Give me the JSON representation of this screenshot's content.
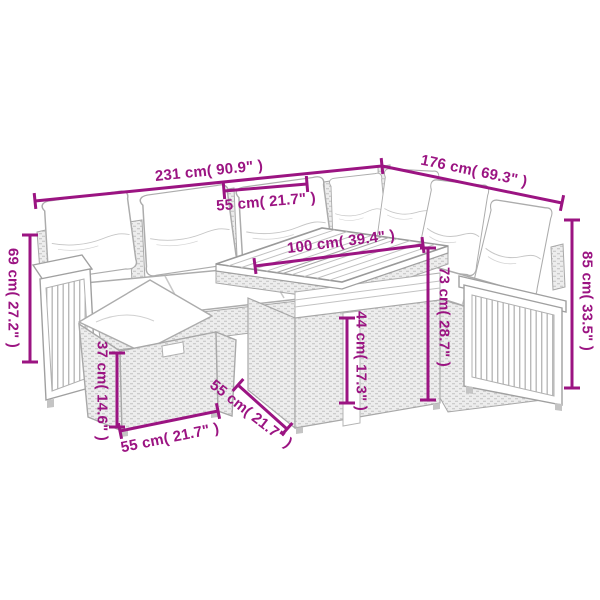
{
  "page": {
    "background": "#ffffff",
    "description": "Product dimension diagram of a modular rattan garden lounge set (corner sofa, ottoman and cube table) drawn as light grey line art with magenta measurement lines"
  },
  "diagram": {
    "accent_color": "#9B1482",
    "sketch_color": "#ACACAC",
    "labels": {
      "overall_width": {
        "text": "231 cm( 90.9\" )",
        "cm": 231,
        "in": 90.9
      },
      "overall_depth": {
        "text": "176 cm( 69.3\" )",
        "cm": 176,
        "in": 69.3
      },
      "seat_width": {
        "text": "55 cm( 21.7\" )",
        "cm": 55,
        "in": 21.7
      },
      "table_length": {
        "text": "100 cm( 39.4\" )",
        "cm": 100,
        "in": 39.4
      },
      "arm_height": {
        "text": "69 cm( 27.2\" )",
        "cm": 69,
        "in": 27.2
      },
      "ottoman_height": {
        "text": "37 cm( 14.6\" )",
        "cm": 37,
        "in": 14.6
      },
      "ottoman_width": {
        "text": "55 cm( 21.7\" )",
        "cm": 55,
        "in": 21.7
      },
      "table_depth": {
        "text": "55 cm( 21.7\" )",
        "cm": 55,
        "in": 21.7
      },
      "table_height": {
        "text": "44 cm( 17.3\" )",
        "cm": 44,
        "in": 17.3
      },
      "sofa_body_height": {
        "text": "73 cm( 28.7\" )",
        "cm": 73,
        "in": 28.7
      },
      "back_height": {
        "text": "85 cm( 33.5\" )",
        "cm": 85,
        "in": 33.5
      }
    }
  }
}
